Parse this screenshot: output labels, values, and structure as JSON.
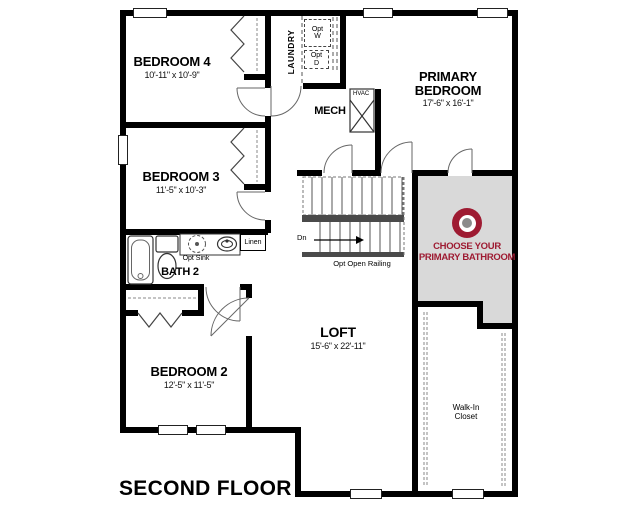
{
  "title": "SECOND FLOOR",
  "colors": {
    "accent_red": "#9E1B32",
    "highlight_bg": "#D9D9D9",
    "wall": "#000000"
  },
  "rooms": {
    "bedroom4": {
      "name": "BEDROOM 4",
      "dims": "10'-11\" x 10'-9\""
    },
    "bedroom3": {
      "name": "BEDROOM 3",
      "dims": "11'-5\" x 10'-3\""
    },
    "bedroom2": {
      "name": "BEDROOM 2",
      "dims": "12'-5\" x 11'-5\""
    },
    "primary_bedroom": {
      "name": "PRIMARY BEDROOM",
      "dims": "17'-6\" x 16'-1\""
    },
    "loft": {
      "name": "LOFT",
      "dims": "15'-6\" x 22'-11\""
    },
    "bath2": {
      "name": "BATH 2"
    },
    "laundry": {
      "name": "LAUNDRY"
    },
    "mech": {
      "name": "MECH"
    },
    "walk_in_closet": {
      "name": "Walk-In Closet"
    }
  },
  "labels": {
    "opt_washer": "Opt W",
    "opt_dryer": "Opt D",
    "opt_sink": "Opt Sink",
    "linen": "Linen",
    "hvac": "HVAC",
    "down": "Dn",
    "opt_open_railing": "Opt Open Railing"
  },
  "option_hotspot": {
    "line1": "CHOOSE YOUR",
    "line2": "PRIMARY BATHROOM",
    "icon": "target-bullseye"
  }
}
